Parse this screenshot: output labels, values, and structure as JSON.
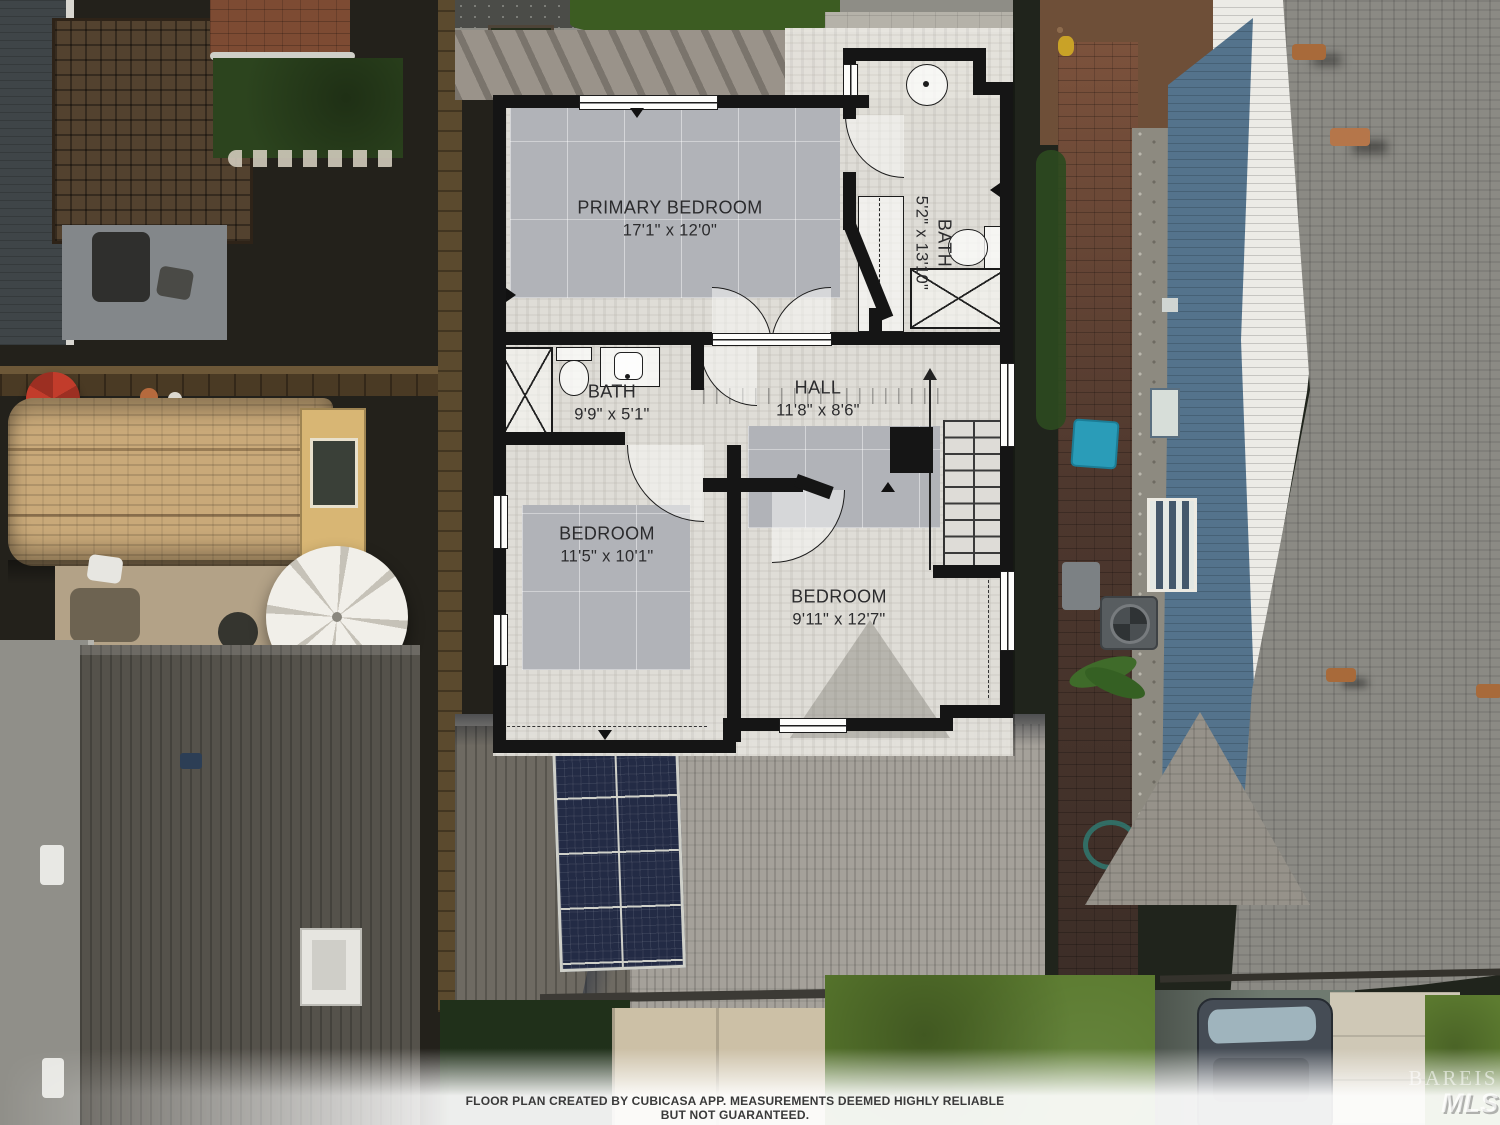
{
  "floor_plan": {
    "rooms": [
      {
        "name": "PRIMARY BEDROOM",
        "dimensions": "17'1\" x 12'0\""
      },
      {
        "name": "BATH",
        "dimensions": "5'2\" x 13'10\""
      },
      {
        "name": "BATH",
        "dimensions": "9'9\" x 5'1\""
      },
      {
        "name": "HALL",
        "dimensions": "11'8\" x 8'6\""
      },
      {
        "name": "BEDROOM",
        "dimensions": "11'5\" x 10'1\""
      },
      {
        "name": "BEDROOM",
        "dimensions": "9'11\" x 12'7\""
      }
    ]
  },
  "footer": {
    "disclaimer": "FLOOR PLAN CREATED BY CUBICASA APP. MEASUREMENTS DEEMED HIGHLY RELIABLE BUT NOT GUARANTEED."
  },
  "watermark": {
    "name": "BAREIS",
    "sub": "MLS"
  },
  "palette": {
    "plan_wall": "#151515",
    "plan_floor": "#eae8e2",
    "carpet": "#b1b3b8",
    "solar_panel": "#232b45",
    "lawn_green": "#5a7a2e",
    "roof_gray": "#8b8a84",
    "shed_tan": "#c9a979",
    "teal_bin": "#2a9cb8",
    "white_wall": "#ecebe6"
  }
}
